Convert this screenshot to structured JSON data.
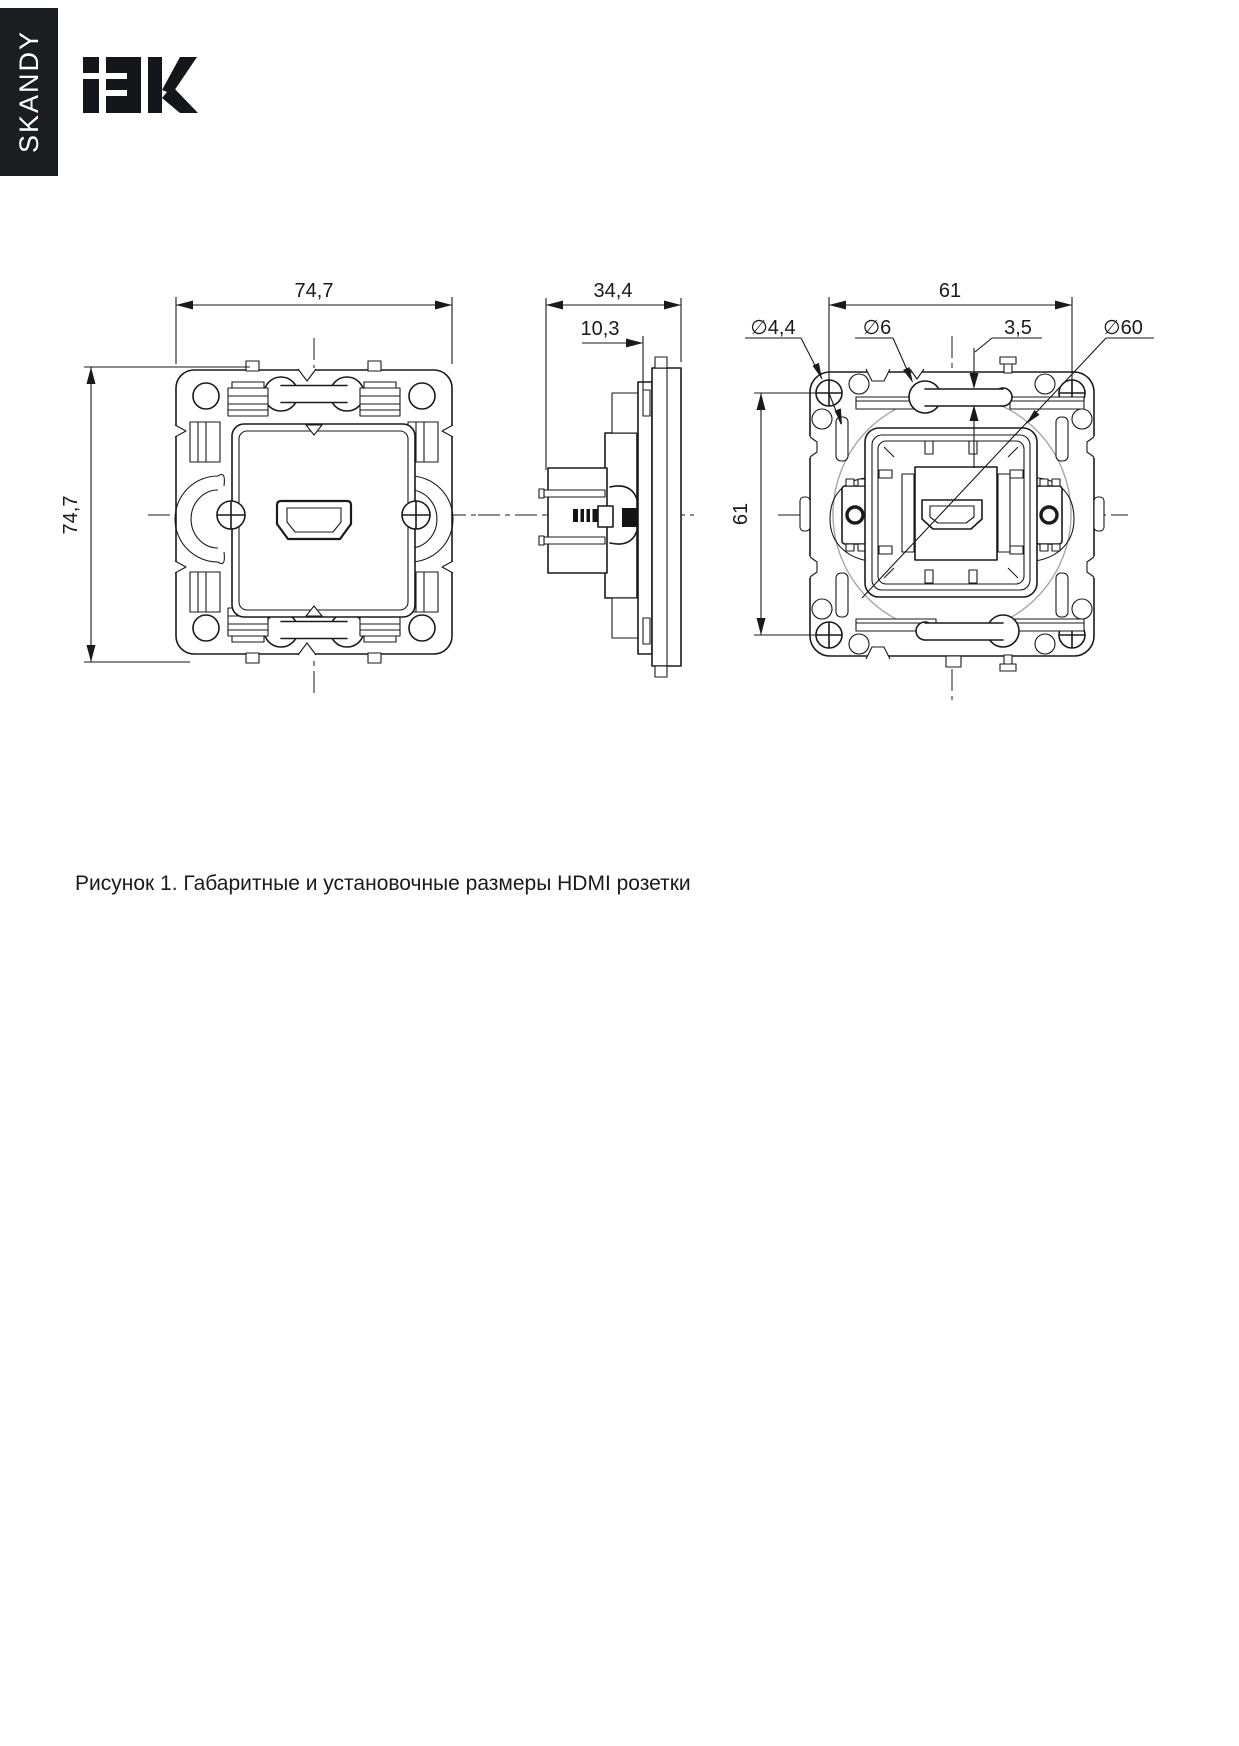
{
  "page": {
    "background": "#ffffff"
  },
  "series_tab": {
    "label": "SKANDY",
    "background": "#1b1d21",
    "text_color": "#ffffff"
  },
  "logo": {
    "text": "iEK",
    "color": "#14161a"
  },
  "figure": {
    "caption": "Рисунок 1. Габаритные и установочные размеры HDMI розетки",
    "line_color": "#1a1a1a",
    "construction_circle_color": "#a6a6a6",
    "views": {
      "front": {
        "width_mm": "74,7",
        "height_mm": "74,7"
      },
      "side": {
        "depth_mm": "34,4",
        "face_depth_mm": "10,3"
      },
      "back": {
        "spacing_h_mm": "61",
        "spacing_v_mm": "61",
        "screw_hole_dia": "∅4,4",
        "hole_dia": "∅6",
        "slot_width_mm": "3,5",
        "mount_circle_dia": "∅60"
      }
    }
  }
}
